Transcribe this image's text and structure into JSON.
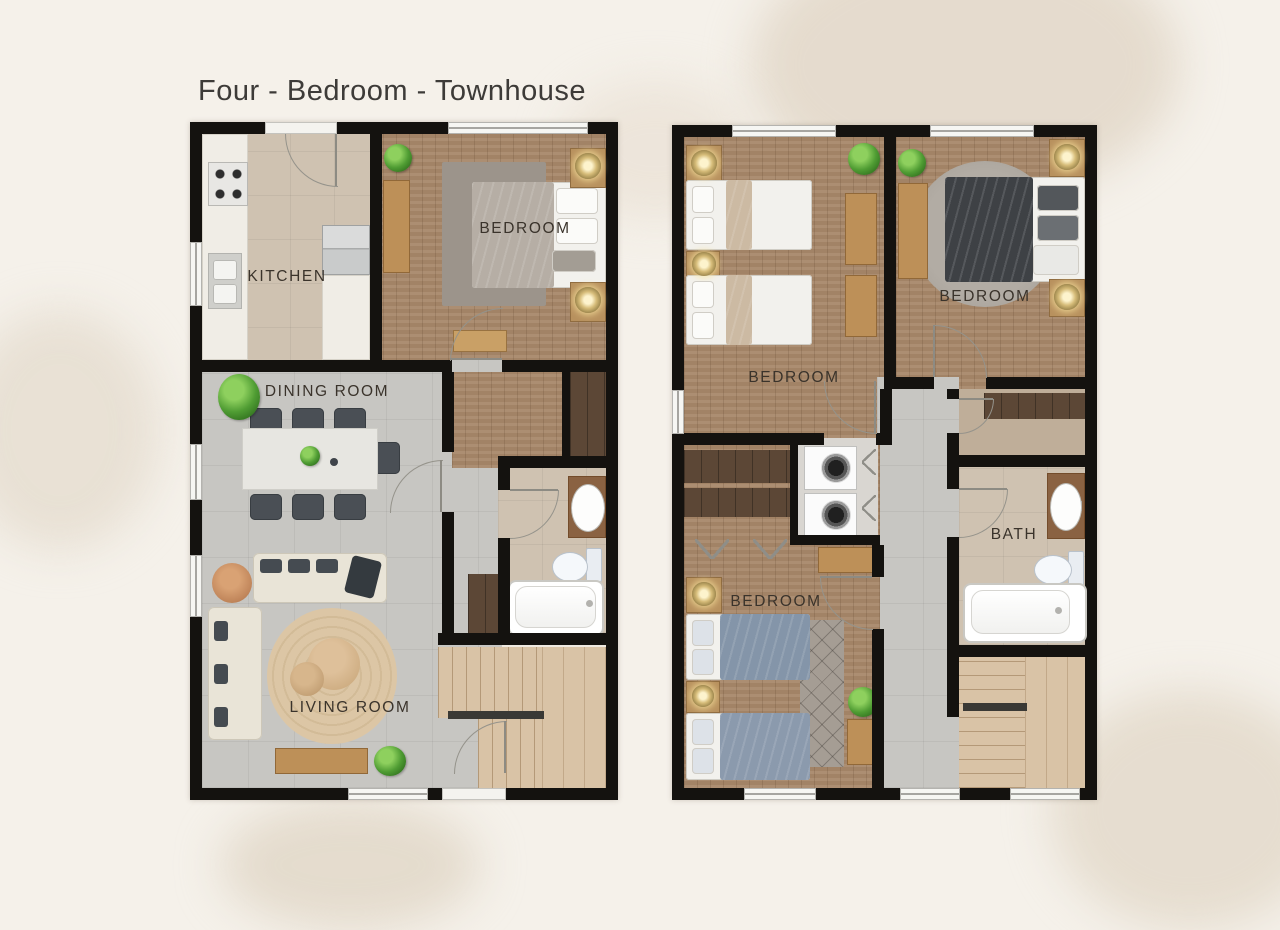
{
  "title": "Four - Bedroom - Townhouse",
  "floor1": {
    "kitchen": "KITCHEN",
    "bedroom": "BEDROOM",
    "dining_room": "DINING ROOM",
    "living_room": "LIVING ROOM"
  },
  "floor2": {
    "bedroom_left": "BEDROOM",
    "bedroom_right": "BEDROOM",
    "bedroom_bottom": "BEDROOM",
    "bath": "BATH"
  },
  "colors": {
    "background": "#f5f1ea",
    "wall": "#14120f",
    "wood_floor": "#a8886a",
    "tile_gray": "#c7c6c2",
    "tile_beige": "#cfc2b1",
    "stair_wood": "#d9c3a6",
    "closet_wood": "#5c4736",
    "label_text": "#3a332b",
    "plant_green": "#4f9c33",
    "lamp_gold": "#d7bd7a",
    "rug_jute": "#dcc6a5",
    "duvet_dark": "#3e4145",
    "duvet_blue": "#8495a9"
  }
}
